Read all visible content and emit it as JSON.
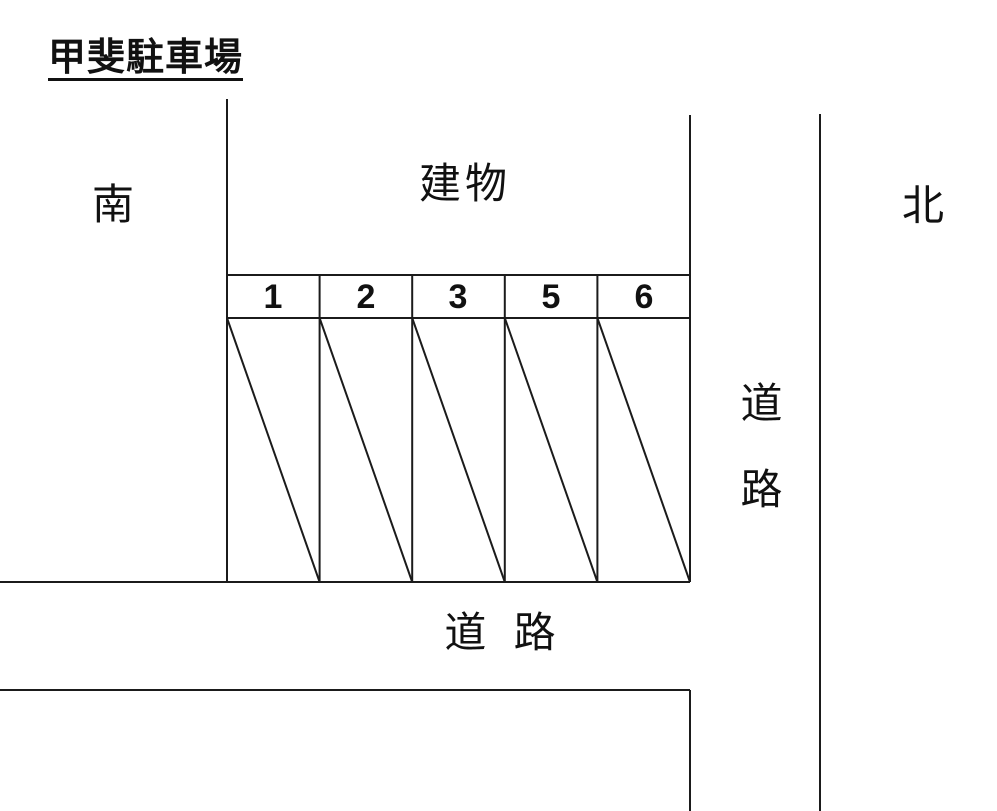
{
  "title": "甲斐駐車場",
  "labels": {
    "south": "南",
    "building": "建物",
    "north": "北",
    "road_right": "道路",
    "road_bottom": "道 路"
  },
  "parking": {
    "spaces": [
      "1",
      "2",
      "3",
      "5",
      "6"
    ]
  },
  "colors": {
    "line": "#1b1b1b",
    "text": "#111111",
    "background": "#ffffff"
  }
}
